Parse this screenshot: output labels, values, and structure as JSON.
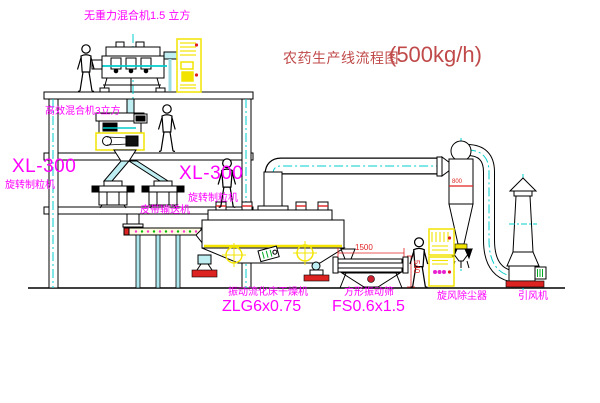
{
  "diagram": {
    "title": "农药生产线流程图",
    "capacity": "(500kg/h)"
  },
  "labels": {
    "gravity_mixer": "无重力混合机1.5 立方",
    "high_mixer": "高效混合机3立方",
    "xl300_left": "XL-300",
    "granulator_left": "旋转制粒机",
    "xl300_mid": "XL-300",
    "granulator_mid": "旋转制粒机",
    "belt_conveyor": "皮带输送机",
    "dryer_name": "振动流化床干燥机",
    "dryer_model": "ZLG6x0.75",
    "screen_name": "方形振动筛",
    "screen_model": "FS0.6x1.5",
    "cyclone": "旋风除尘器",
    "fan": "引风机"
  },
  "dimensions": {
    "screen_length": "1500",
    "screen_height": "540",
    "cyclone_mark": "800"
  },
  "colors": {
    "label_magenta": "#ff00ff",
    "title_red": "#c04a4a",
    "dimension_red": "#e02020",
    "centerline_cyan": "#00cccc",
    "pipe_cyan": "#bfeef2",
    "accent_yellow": "#f2e400",
    "base_red": "#dd2222",
    "line_black": "#000000"
  }
}
